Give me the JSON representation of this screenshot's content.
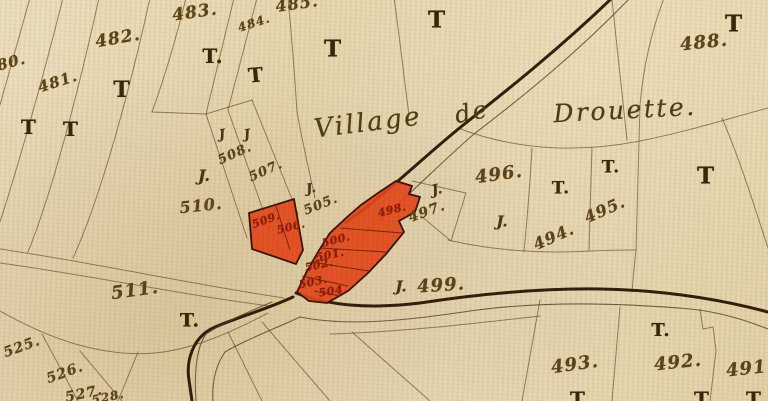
{
  "map": {
    "title": "Village de Drouette",
    "palette": {
      "paper": "#e8d8b0",
      "ink": "#5d4517",
      "road_ink": "#2a1504",
      "building_fill": "#e4491b",
      "building_number_ink": "#8e1d08"
    },
    "labels": [
      {
        "t": "480.",
        "x": 6,
        "y": 64,
        "s": 15,
        "r": -15,
        "c": "num",
        "n": "parcel-number-480"
      },
      {
        "t": "481.",
        "x": 58,
        "y": 82,
        "s": 15,
        "r": -18,
        "c": "num",
        "n": "parcel-number-481"
      },
      {
        "t": "482.",
        "x": 118,
        "y": 39,
        "s": 17,
        "r": -10,
        "c": "num",
        "n": "parcel-number-482"
      },
      {
        "t": "483.",
        "x": 195,
        "y": 13,
        "s": 17,
        "r": -8,
        "c": "num",
        "n": "parcel-number-483"
      },
      {
        "t": "484.",
        "x": 254,
        "y": 23,
        "s": 12,
        "r": -18,
        "c": "num",
        "n": "parcel-number-484"
      },
      {
        "t": "485.",
        "x": 297,
        "y": 4,
        "s": 16,
        "r": -8,
        "c": "num",
        "n": "parcel-number-485"
      },
      {
        "t": "488.",
        "x": 704,
        "y": 43,
        "s": 18,
        "r": -6,
        "c": "num",
        "n": "parcel-number-488"
      },
      {
        "t": "491.",
        "x": 750,
        "y": 369,
        "s": 18,
        "r": -6,
        "c": "num",
        "n": "parcel-number-491"
      },
      {
        "t": "492.",
        "x": 678,
        "y": 363,
        "s": 18,
        "r": -6,
        "c": "num",
        "n": "parcel-number-492"
      },
      {
        "t": "493.",
        "x": 575,
        "y": 365,
        "s": 18,
        "r": -8,
        "c": "num",
        "n": "parcel-number-493"
      },
      {
        "t": "494.",
        "x": 554,
        "y": 237,
        "s": 16,
        "r": -24,
        "c": "num",
        "n": "parcel-number-494"
      },
      {
        "t": "495.",
        "x": 605,
        "y": 210,
        "s": 16,
        "r": -24,
        "c": "num",
        "n": "parcel-number-495"
      },
      {
        "t": "496.",
        "x": 499,
        "y": 175,
        "s": 18,
        "r": -8,
        "c": "num",
        "n": "parcel-number-496"
      },
      {
        "t": "497.",
        "x": 427,
        "y": 212,
        "s": 14,
        "r": -20,
        "c": "num",
        "n": "parcel-number-497"
      },
      {
        "t": "499.",
        "x": 441,
        "y": 286,
        "s": 18,
        "r": -4,
        "c": "num",
        "n": "parcel-number-499"
      },
      {
        "t": "505.",
        "x": 321,
        "y": 205,
        "s": 13,
        "r": -22,
        "c": "num",
        "n": "parcel-number-505"
      },
      {
        "t": "507.",
        "x": 266,
        "y": 171,
        "s": 13,
        "r": -24,
        "c": "num",
        "n": "parcel-number-507"
      },
      {
        "t": "508.",
        "x": 235,
        "y": 154,
        "s": 13,
        "r": -24,
        "c": "num",
        "n": "parcel-number-508"
      },
      {
        "t": "510.",
        "x": 201,
        "y": 206,
        "s": 16,
        "r": -6,
        "c": "num",
        "n": "parcel-number-510"
      },
      {
        "t": "511.",
        "x": 135,
        "y": 291,
        "s": 18,
        "r": -8,
        "c": "num",
        "n": "parcel-number-511"
      },
      {
        "t": "525.",
        "x": 22,
        "y": 347,
        "s": 14,
        "r": -20,
        "c": "num",
        "n": "parcel-number-525"
      },
      {
        "t": "526.",
        "x": 65,
        "y": 373,
        "s": 14,
        "r": -20,
        "c": "num",
        "n": "parcel-number-526"
      },
      {
        "t": "527.",
        "x": 84,
        "y": 394,
        "s": 14,
        "r": -12,
        "c": "num",
        "n": "parcel-number-527"
      },
      {
        "t": "528.",
        "x": 108,
        "y": 397,
        "s": 12,
        "r": -12,
        "c": "num",
        "n": "parcel-number-528"
      },
      {
        "t": "498.",
        "x": 392,
        "y": 210,
        "s": 11,
        "r": -14,
        "c": "rednum",
        "n": "building-number-498"
      },
      {
        "t": "500.",
        "x": 336,
        "y": 240,
        "s": 11,
        "r": -14,
        "c": "rednum",
        "n": "building-number-500"
      },
      {
        "t": "501.",
        "x": 330,
        "y": 255,
        "s": 11,
        "r": -12,
        "c": "rednum",
        "n": "building-number-501"
      },
      {
        "t": "502.",
        "x": 319,
        "y": 265,
        "s": 11,
        "r": -12,
        "c": "rednum",
        "n": "building-number-502"
      },
      {
        "t": "503.",
        "x": 313,
        "y": 282,
        "s": 11,
        "r": -12,
        "c": "rednum",
        "n": "building-number-503"
      },
      {
        "t": "504.",
        "x": 333,
        "y": 291,
        "s": 11,
        "r": -8,
        "c": "rednum",
        "n": "building-number-504"
      },
      {
        "t": "506.",
        "x": 291,
        "y": 227,
        "s": 11,
        "r": -14,
        "c": "rednum",
        "n": "building-number-506"
      },
      {
        "t": "509.",
        "x": 266,
        "y": 220,
        "s": 11,
        "r": -20,
        "c": "rednum",
        "n": "building-number-509"
      },
      {
        "t": "T",
        "x": 29,
        "y": 127,
        "s": 20,
        "r": 0,
        "c": "tee",
        "n": "tenure-mark-T"
      },
      {
        "t": "T",
        "x": 71,
        "y": 129,
        "s": 20,
        "r": 0,
        "c": "tee",
        "n": "tenure-mark-T"
      },
      {
        "t": "T",
        "x": 122,
        "y": 90,
        "s": 22,
        "r": 0,
        "c": "tee",
        "n": "tenure-mark-T"
      },
      {
        "t": "T.",
        "x": 213,
        "y": 56,
        "s": 20,
        "r": 0,
        "c": "tee",
        "n": "tenure-mark-T"
      },
      {
        "t": "T",
        "x": 256,
        "y": 75,
        "s": 20,
        "r": -5,
        "c": "tee",
        "n": "tenure-mark-T"
      },
      {
        "t": "T",
        "x": 333,
        "y": 49,
        "s": 23,
        "r": 0,
        "c": "tee",
        "n": "tenure-mark-T"
      },
      {
        "t": "T",
        "x": 437,
        "y": 20,
        "s": 23,
        "r": 0,
        "c": "tee",
        "n": "tenure-mark-T"
      },
      {
        "t": "T",
        "x": 734,
        "y": 24,
        "s": 23,
        "r": 0,
        "c": "tee",
        "n": "tenure-mark-T"
      },
      {
        "t": "T.",
        "x": 561,
        "y": 189,
        "s": 17,
        "r": 0,
        "c": "tee",
        "n": "tenure-mark-T"
      },
      {
        "t": "T.",
        "x": 611,
        "y": 168,
        "s": 17,
        "r": 0,
        "c": "tee",
        "n": "tenure-mark-T"
      },
      {
        "t": "T",
        "x": 706,
        "y": 176,
        "s": 23,
        "r": 0,
        "c": "tee",
        "n": "tenure-mark-T"
      },
      {
        "t": "T.",
        "x": 190,
        "y": 321,
        "s": 19,
        "r": 0,
        "c": "tee",
        "n": "tenure-mark-T"
      },
      {
        "t": "T.",
        "x": 661,
        "y": 331,
        "s": 18,
        "r": 0,
        "c": "tee",
        "n": "tenure-mark-T"
      },
      {
        "t": "T",
        "x": 578,
        "y": 399,
        "s": 20,
        "r": 0,
        "c": "tee",
        "n": "tenure-mark-T"
      },
      {
        "t": "T",
        "x": 702,
        "y": 399,
        "s": 20,
        "r": 0,
        "c": "tee",
        "n": "tenure-mark-T"
      },
      {
        "t": "T",
        "x": 754,
        "y": 399,
        "s": 20,
        "r": 0,
        "c": "tee",
        "n": "tenure-mark-T"
      },
      {
        "t": "J",
        "x": 222,
        "y": 135,
        "s": 13,
        "r": -8,
        "c": "jay",
        "n": "tenure-mark-J"
      },
      {
        "t": "J",
        "x": 247,
        "y": 135,
        "s": 13,
        "r": -8,
        "c": "jay",
        "n": "tenure-mark-J"
      },
      {
        "t": "J.",
        "x": 204,
        "y": 176,
        "s": 16,
        "r": 0,
        "c": "jay",
        "n": "tenure-mark-J"
      },
      {
        "t": "J.",
        "x": 311,
        "y": 189,
        "s": 13,
        "r": -10,
        "c": "jay",
        "n": "tenure-mark-J"
      },
      {
        "t": "J.",
        "x": 437,
        "y": 190,
        "s": 14,
        "r": -12,
        "c": "jay",
        "n": "tenure-mark-J"
      },
      {
        "t": "J.",
        "x": 502,
        "y": 222,
        "s": 15,
        "r": 0,
        "c": "jay",
        "n": "tenure-mark-J"
      },
      {
        "t": "J.",
        "x": 401,
        "y": 287,
        "s": 15,
        "r": 0,
        "c": "jay",
        "n": "tenure-mark-J"
      },
      {
        "t": "Village",
        "x": 368,
        "y": 123,
        "s": 26,
        "r": -7,
        "c": "title",
        "n": "village-name-part"
      },
      {
        "t": "de",
        "x": 472,
        "y": 112,
        "s": 24,
        "r": -12,
        "c": "title",
        "n": "village-name-part"
      },
      {
        "t": "Drouette.",
        "x": 625,
        "y": 110,
        "s": 25,
        "r": -3,
        "c": "title",
        "n": "village-name-part"
      }
    ]
  }
}
